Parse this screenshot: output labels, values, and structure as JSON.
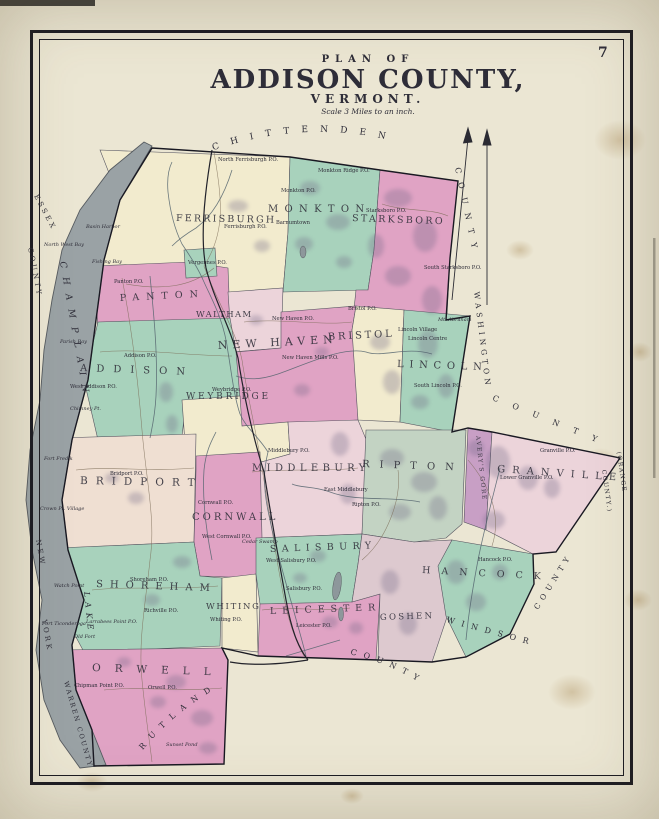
{
  "page": {
    "number": "7"
  },
  "title": {
    "kicker": "PLAN OF",
    "main": "ADDISON COUNTY,",
    "sub": "VERMONT.",
    "scale": "Scale 3 Miles to an inch."
  },
  "colors": {
    "pink": "#e0a3c4",
    "pale_pink": "#ecd4da",
    "blush": "#efdfd2",
    "green": "#a8d2bc",
    "pale_green": "#c3d3c3",
    "cream": "#f2ebce",
    "mauve": "#ddc9cf",
    "gore": "#c89fc5",
    "lake": "#9aa2a5",
    "margin": "#ebe6d3",
    "ink": "#1b1b22"
  },
  "towns": [
    {
      "name": "FERRISBURGH"
    },
    {
      "name": "MONKTON"
    },
    {
      "name": "STARKSBORO"
    },
    {
      "name": "PANTON"
    },
    {
      "name": "WALTHAM"
    },
    {
      "name": "NEW HAVEN"
    },
    {
      "name": "BRISTOL"
    },
    {
      "name": "LINCOLN"
    },
    {
      "name": "ADDISON"
    },
    {
      "name": "WEYBRIDGE"
    },
    {
      "name": "MIDDLEBURY"
    },
    {
      "name": "RIPTON"
    },
    {
      "name": "BRIDPORT"
    },
    {
      "name": "CORNWALL"
    },
    {
      "name": "SHOREHAM"
    },
    {
      "name": "WHITING"
    },
    {
      "name": "SALISBURY"
    },
    {
      "name": "LEICESTER"
    },
    {
      "name": "GOSHEN"
    },
    {
      "name": "HANCOCK"
    },
    {
      "name": "GRANVILLE"
    },
    {
      "name": "AVERY'S GORE"
    },
    {
      "name": "ORWELL"
    }
  ],
  "counties": [
    {
      "name": "CHITTENDEN"
    },
    {
      "name": "COUNTY"
    },
    {
      "name": "WASHINGTON"
    },
    {
      "name": "COUNTY"
    },
    {
      "name": "(ORANGE"
    },
    {
      "name": "COUNTY.)"
    },
    {
      "name": "WINDSOR"
    },
    {
      "name": "COUNTY"
    },
    {
      "name": "RUTLAND"
    },
    {
      "name": "COUNTY"
    },
    {
      "name": "WARREN COUNTY"
    },
    {
      "name": "ESSEX"
    },
    {
      "name": "COUNTY"
    },
    {
      "name": "NEW"
    },
    {
      "name": "YORK"
    }
  ],
  "water": [
    {
      "name": "LAKE"
    },
    {
      "name": "CHAMPLAIN"
    },
    {
      "name": "North West Bay"
    },
    {
      "name": "Basin Harbor"
    },
    {
      "name": "Fishing Bay"
    },
    {
      "name": "Parish Bay"
    },
    {
      "name": "Watch Point"
    },
    {
      "name": "Larrabees Point P.O."
    },
    {
      "name": "Fort Ticonderoga"
    },
    {
      "name": "Old Fort"
    },
    {
      "name": "Chimney Pt."
    },
    {
      "name": "Fort Fred'k"
    },
    {
      "name": "Crown Pt. Village"
    },
    {
      "name": "Cedar Swamp"
    },
    {
      "name": "Sunset Pond"
    },
    {
      "name": "Mt. Abraham"
    }
  ],
  "places": [
    {
      "name": "North Ferrisburgh P.O."
    },
    {
      "name": "Monkton Ridge P.O."
    },
    {
      "name": "Monkton P.O."
    },
    {
      "name": "Ferrisburgh P.O."
    },
    {
      "name": "Vergennes P.O."
    },
    {
      "name": "Panton P.O."
    },
    {
      "name": "Starksboro P.O."
    },
    {
      "name": "South Starksboro P.O."
    },
    {
      "name": "Addison P.O."
    },
    {
      "name": "West Addison P.O."
    },
    {
      "name": "New Haven P.O."
    },
    {
      "name": "New Haven Mills P.O."
    },
    {
      "name": "Bristol P.O."
    },
    {
      "name": "Lincoln Village"
    },
    {
      "name": "Lincoln Centre"
    },
    {
      "name": "South Lincoln P.O."
    },
    {
      "name": "Weybridge P.O."
    },
    {
      "name": "Middlebury P.O."
    },
    {
      "name": "East Middlebury"
    },
    {
      "name": "Ripton P.O."
    },
    {
      "name": "Bridport P.O."
    },
    {
      "name": "Cornwall P.O."
    },
    {
      "name": "West Cornwall P.O."
    },
    {
      "name": "West Salisbury P.O."
    },
    {
      "name": "Salisbury P.O."
    },
    {
      "name": "Whiting P.O."
    },
    {
      "name": "Leicester P.O."
    },
    {
      "name": "Shoreham P.O."
    },
    {
      "name": "Richville P.O."
    },
    {
      "name": "Orwell P.O."
    },
    {
      "name": "Chipman Point P.O."
    },
    {
      "name": "Hancock P.O."
    },
    {
      "name": "Lower Granville P.O."
    },
    {
      "name": "Granville P.O."
    },
    {
      "name": "Barnumtown"
    }
  ]
}
